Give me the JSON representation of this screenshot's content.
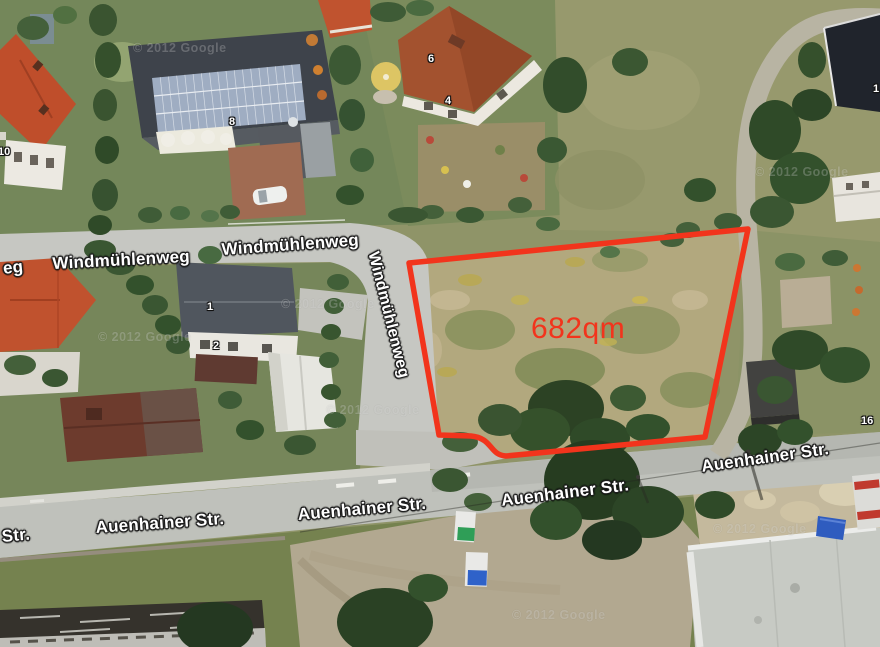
{
  "map": {
    "type": "satellite-aerial-view",
    "area_label": {
      "text": "682qm",
      "x": 531,
      "y": 312,
      "font_size": 30
    },
    "plot_outline": {
      "area_text": "682qm"
    },
    "street_labels": [
      {
        "text": "eg",
        "x": 2,
        "y": 259,
        "rot": -6
      },
      {
        "text": "Windmühlenweg",
        "x": 52,
        "y": 254,
        "rot": -3
      },
      {
        "text": "Windmühlenweg",
        "x": 221,
        "y": 240,
        "rot": -4
      },
      {
        "text": "Windmühlenweg",
        "x": 381,
        "y": 250,
        "rot": 76
      },
      {
        "text": "Str.",
        "x": 1,
        "y": 527,
        "rot": -5
      },
      {
        "text": "Auenhainer Str.",
        "x": 95,
        "y": 518,
        "rot": -4
      },
      {
        "text": "Auenhainer Str.",
        "x": 297,
        "y": 505,
        "rot": -5
      },
      {
        "text": "Auenhainer Str.",
        "x": 500,
        "y": 491,
        "rot": -7
      },
      {
        "text": "Auenhainer Str.",
        "x": 700,
        "y": 457,
        "rot": -8
      }
    ],
    "house_numbers": [
      {
        "text": "10",
        "x": -2,
        "y": 146
      },
      {
        "text": "8",
        "x": 229,
        "y": 116
      },
      {
        "text": "6",
        "x": 428,
        "y": 53
      },
      {
        "text": "4",
        "x": 445,
        "y": 95
      },
      {
        "text": "1",
        "x": 207,
        "y": 301
      },
      {
        "text": "2",
        "x": 213,
        "y": 340
      },
      {
        "text": "16",
        "x": 861,
        "y": 415
      },
      {
        "text": "1",
        "x": 873,
        "y": 83
      }
    ],
    "watermarks": [
      {
        "text": "© 2012 Google",
        "x": 133,
        "y": 41
      },
      {
        "text": "© 2012 Google",
        "x": 98,
        "y": 330
      },
      {
        "text": "© 2012 Google",
        "x": 281,
        "y": 297
      },
      {
        "text": "© 2012 Google",
        "x": 326,
        "y": 403
      },
      {
        "text": "© 2012 Google",
        "x": 755,
        "y": 165
      },
      {
        "text": "© 2012 Google",
        "x": 713,
        "y": 522
      },
      {
        "text": "© 2012 Google",
        "x": 512,
        "y": 608
      }
    ]
  },
  "colors": {
    "plot_red": "#f2341c",
    "street_label_fill": "#ffffff",
    "street_label_outline": "#1c1c1c"
  }
}
